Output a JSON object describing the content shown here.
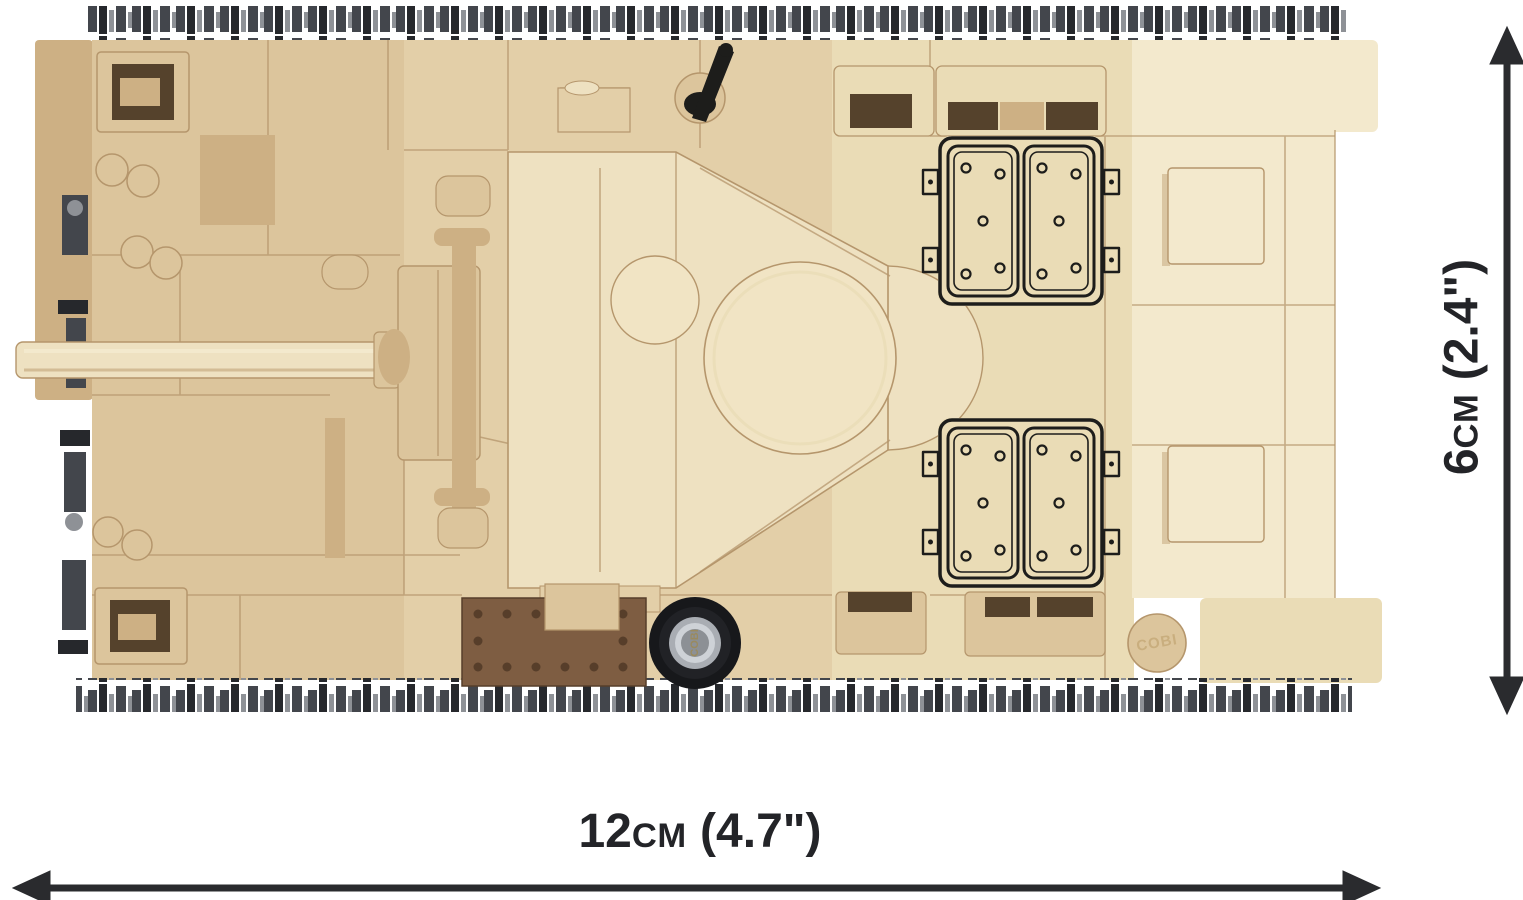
{
  "product_image": {
    "description": "Top view of a sand-colored COBI brick-built tank model with gun barrel pointing left, printed engine hatches, tracks top and bottom",
    "wheel_hub_logo": "COBI",
    "stud_logo": "COBI"
  },
  "dimensions": {
    "width": {
      "value": "12",
      "unit": "cm",
      "imperial": "(4.7\")"
    },
    "height": {
      "value": "6",
      "unit": "cm",
      "imperial": "(2.4\")"
    }
  },
  "colors": {
    "bg": "#ffffff",
    "dim": "#2a2b2e",
    "label": "#232428",
    "ink": "#1d1d1b",
    "tan": "#dcc59c",
    "tanMid": "#e3cfa8",
    "tanDark": "#cdb084",
    "tanShadow": "#c2a478",
    "cream": "#eadcb6",
    "creamLight": "#f3e9cd",
    "turret": "#eee1c1",
    "turretLight": "#f1e4c4",
    "seam": "#b5966c",
    "brown": "#7e5d42",
    "brownDark": "#573e2a",
    "slot": "#55422c",
    "trackDark": "#26282c",
    "trackMid": "#43464c",
    "trackLight": "#8e9196",
    "wheel": "#17181b",
    "hub": "#a9adb3",
    "hubLight": "#ced2d7",
    "studGold": "#c9ae7e"
  }
}
